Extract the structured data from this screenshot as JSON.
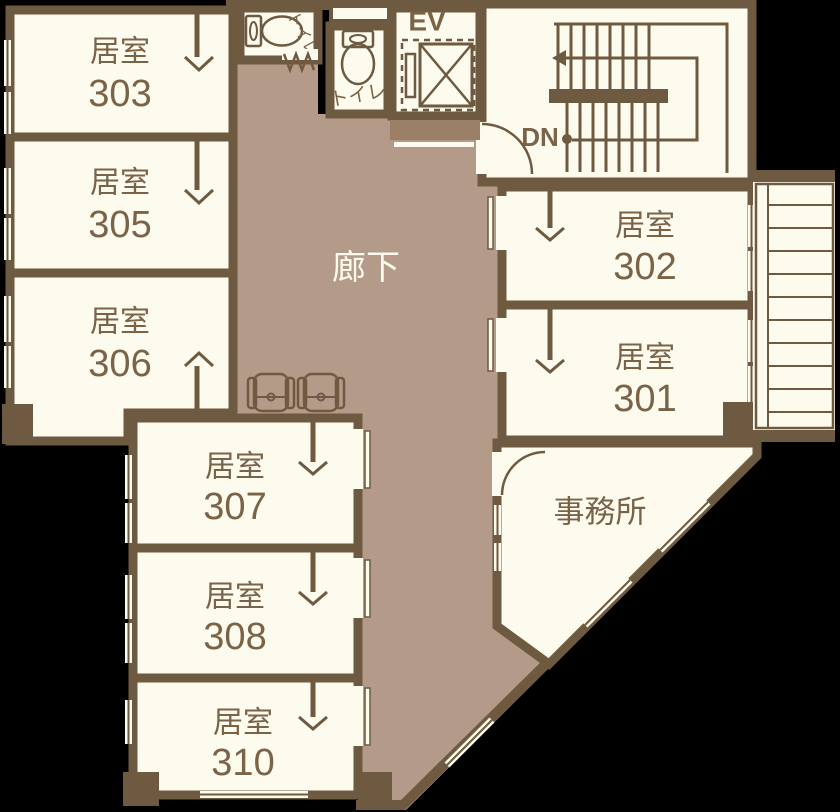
{
  "title": "3F floor plan",
  "palette": {
    "wall": "#6e5a40",
    "room_floor": "#fdfaee",
    "corridor_floor": "#b49a89",
    "entry_mat": "#9b8067",
    "label_text": "#7a6347",
    "corridor_text": "#fdfaee",
    "background": "#000000"
  },
  "rooms": {
    "r303": {
      "type": "居室",
      "number": "303"
    },
    "r305": {
      "type": "居室",
      "number": "305"
    },
    "r306": {
      "type": "居室",
      "number": "306"
    },
    "r307": {
      "type": "居室",
      "number": "307"
    },
    "r308": {
      "type": "居室",
      "number": "308"
    },
    "r310": {
      "type": "居室",
      "number": "310"
    },
    "r302": {
      "type": "居室",
      "number": "302"
    },
    "r301": {
      "type": "居室",
      "number": "301"
    }
  },
  "areas": {
    "corridor": "廊下",
    "office": "事務所",
    "toilet_a": "トイレ",
    "toilet_b": "トイレ"
  },
  "labels": {
    "elevator": "EV",
    "stairs_down": "DN"
  },
  "icons": [
    "toilet-icon",
    "elevator-shaft-icon",
    "staircase-icon",
    "down-arrow-icon",
    "armchair-icon",
    "door-swing-icon",
    "door-chevron-icon",
    "window-slit",
    "balcony-ladder-icon"
  ]
}
